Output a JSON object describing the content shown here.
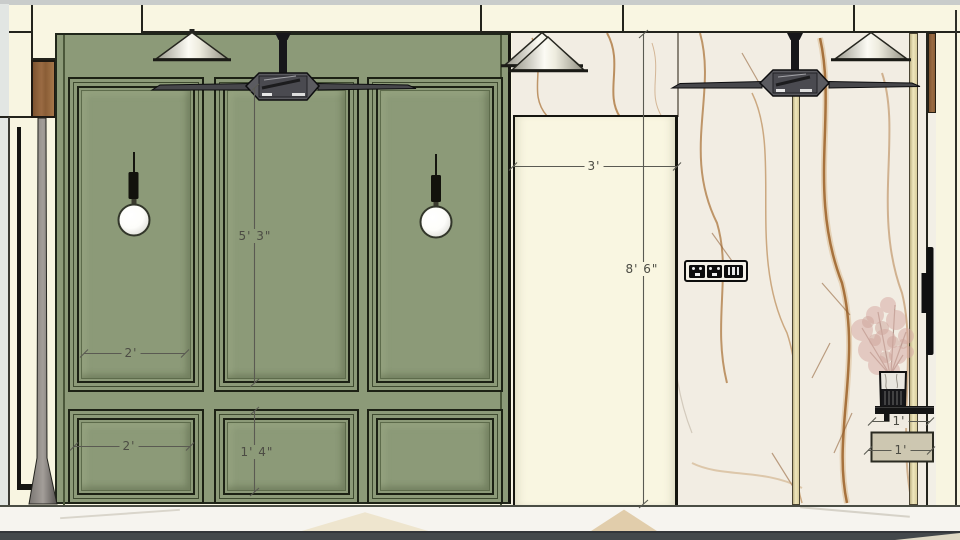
{
  "drawing": {
    "type": "interior wall elevation",
    "description": "Elevation with green panelled wainscot wall, marble feature wall, ceiling fans, cone and globe pendant lights, power outlet, shelf with vase and plant"
  },
  "dimensions": {
    "upper_panel_height": "5' 3\"",
    "upper_panel_width": "2'",
    "lower_panel_width": "2'",
    "lower_panel_height": "1' 4\"",
    "opening_width": "3'",
    "wall_height": "8' 6\"",
    "shelf_depth": "1'",
    "console_depth": "1'"
  },
  "colors": {
    "wall_cream": "#F8F5E1",
    "panel_green": "#8C9A78",
    "molding_dark": "#1C2114",
    "marble_base": "#F2EDE3",
    "marble_vein": "#9C6128",
    "gold_trim": "#EFE7BD",
    "wood": "#8A5D36",
    "floor_dark": "#43484B",
    "dimension_text": "#4C4C44"
  }
}
